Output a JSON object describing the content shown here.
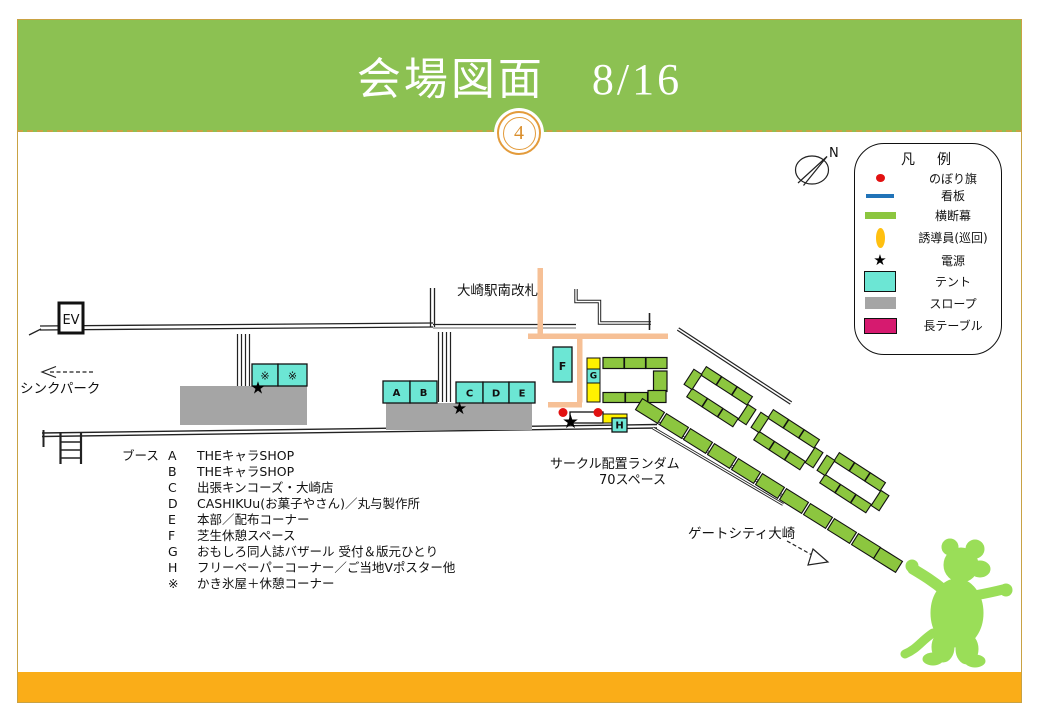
{
  "slide": {
    "title": "会場図面　8/16",
    "page_number": "4"
  },
  "icons": {
    "star": "★"
  },
  "compass": {
    "label": "N"
  },
  "legend": {
    "title": "凡　例",
    "items": [
      {
        "marker": "red-dot",
        "label": "のぼり旗"
      },
      {
        "marker": "blue-line",
        "label": "看板"
      },
      {
        "marker": "green-line",
        "label": "横断幕"
      },
      {
        "marker": "yellow-oval",
        "label": "誘導員(巡回)"
      },
      {
        "marker": "black-star",
        "label": "電源"
      },
      {
        "marker": "cyan-box",
        "label": "テント"
      },
      {
        "marker": "gray-box",
        "label": "スロープ"
      },
      {
        "marker": "magenta-box",
        "label": "長テーブル"
      }
    ]
  },
  "map": {
    "ev_label": "EV",
    "station_gate_label": "大崎駅南改札",
    "think_park_label": "シンクパーク",
    "gate_city_label": "ゲートシティ大崎",
    "circle_note_line1": "サークル配置ランダム",
    "circle_note_line2": "70スペース",
    "tent_labels": {
      "a": "A",
      "b": "B",
      "c": "C",
      "d": "D",
      "e": "E",
      "f": "F",
      "g": "G",
      "h": "H",
      "kakigori1": "※",
      "kakigori2": "※"
    }
  },
  "booth_list": {
    "prefix": "ブース",
    "items": [
      {
        "id": "A",
        "name": "THEキャラSHOP"
      },
      {
        "id": "B",
        "name": "THEキャラSHOP"
      },
      {
        "id": "C",
        "name": "出張キンコーズ・大崎店"
      },
      {
        "id": "D",
        "name": " CASHIKUu(お菓子やさん)／丸与製作所"
      },
      {
        "id": "E",
        "name": "本部／配布コーナー"
      },
      {
        "id": "F",
        "name": "芝生休憩スペース"
      },
      {
        "id": "G",
        "name": "おもしろ同人誌バザール 受付＆版元ひとり"
      },
      {
        "id": "H",
        "name": "フリーペーパーコーナー／ご当地Vポスター他"
      },
      {
        "id": "※",
        "name": "かき氷屋＋休憩コーナー"
      }
    ]
  },
  "colors": {
    "header_green": "#8CC152",
    "footer_orange": "#FAAD18",
    "gold_border": "#C9A243",
    "tent_cyan": "#6CE6D4",
    "slope_gray": "#A5A5A5",
    "table_magenta": "#D61A6F",
    "signboard_blue": "#2173B8",
    "banner_green": "#8CC63F",
    "flag_red": "#E21111",
    "guide_yellow": "#FFC010",
    "path_peach": "#F6C096",
    "mascot_green": "#9ADE58"
  }
}
